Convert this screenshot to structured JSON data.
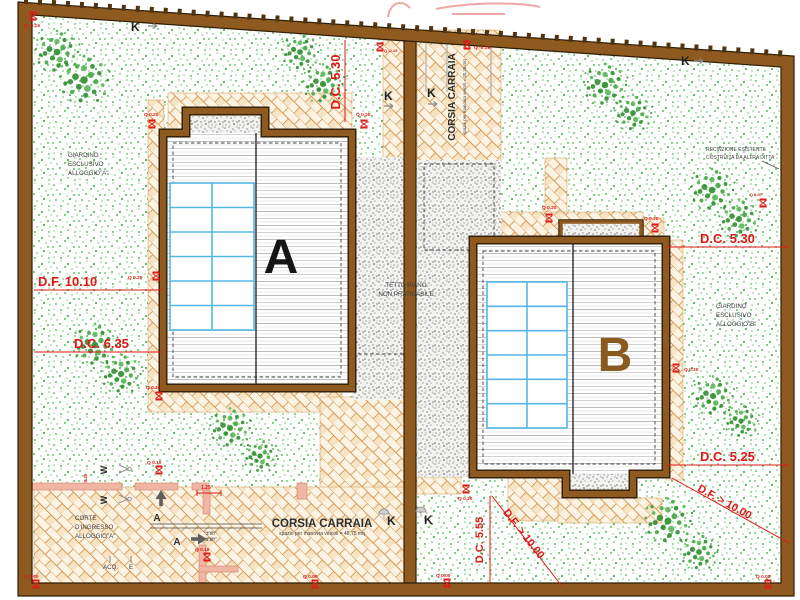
{
  "drawing": {
    "type": "architectural-site-plan",
    "buildings": {
      "a": "A",
      "b": "B"
    },
    "areas": {
      "garden_a": [
        "GIARDINO",
        "ESCLUSIVO",
        "ALLOGGIO\"A\""
      ],
      "garden_b": [
        "GIARDINO",
        "ESCLUSIVO",
        "ALLOGGIO\"B\""
      ],
      "corte_a": [
        "CORTE",
        "D'INGRESSO",
        "ALLOGGIO\"A\""
      ],
      "tetto": [
        "TETTO PIANO",
        "NON PRATICABILE"
      ],
      "recinzione": [
        "RECINZIONE ESISTENTE",
        "COSTRUITA DA ALTRA DITTA"
      ],
      "corsia_top": {
        "title": "CORSIA CARRAIA",
        "subtitle": "spazio per manovra veicoli = 20,35 mq"
      },
      "corsia_bottom": {
        "title": "CORSIA CARRAIA",
        "subtitle": "spazio per manovra veicoli = 48,75 mq"
      }
    },
    "dimensions": {
      "dc530_top": "D.C. 5.30",
      "dc530_right": "D.C. 5.30",
      "df1010": "D.F. 10.10",
      "dc635": "D.C. 6.35",
      "dc525": "D.C. 5.25",
      "dc555": "D.C. 5.55",
      "df10": "D.F. > 10.00",
      "d125": "1.25",
      "d300": "3.00",
      "d160": "1.60",
      "w020": "0.20"
    },
    "elevations": {
      "m015": "Q -0.15",
      "m019": "Q -0.19",
      "q020": "Q 0.20",
      "q010": "Q 0.10",
      "q000": "Q 0.00"
    },
    "symbols": {
      "gate_k": "K",
      "gate_w": "W",
      "section_a": "A",
      "acq": "ACQ.",
      "e": "E"
    },
    "colors": {
      "wall_brown": "#8f5a1f",
      "dimension_red": "#e01818",
      "panel_blue": "#54b7e8",
      "label_b_brown": "#8a5a1e",
      "tree_green": "#3d9b3d"
    }
  }
}
